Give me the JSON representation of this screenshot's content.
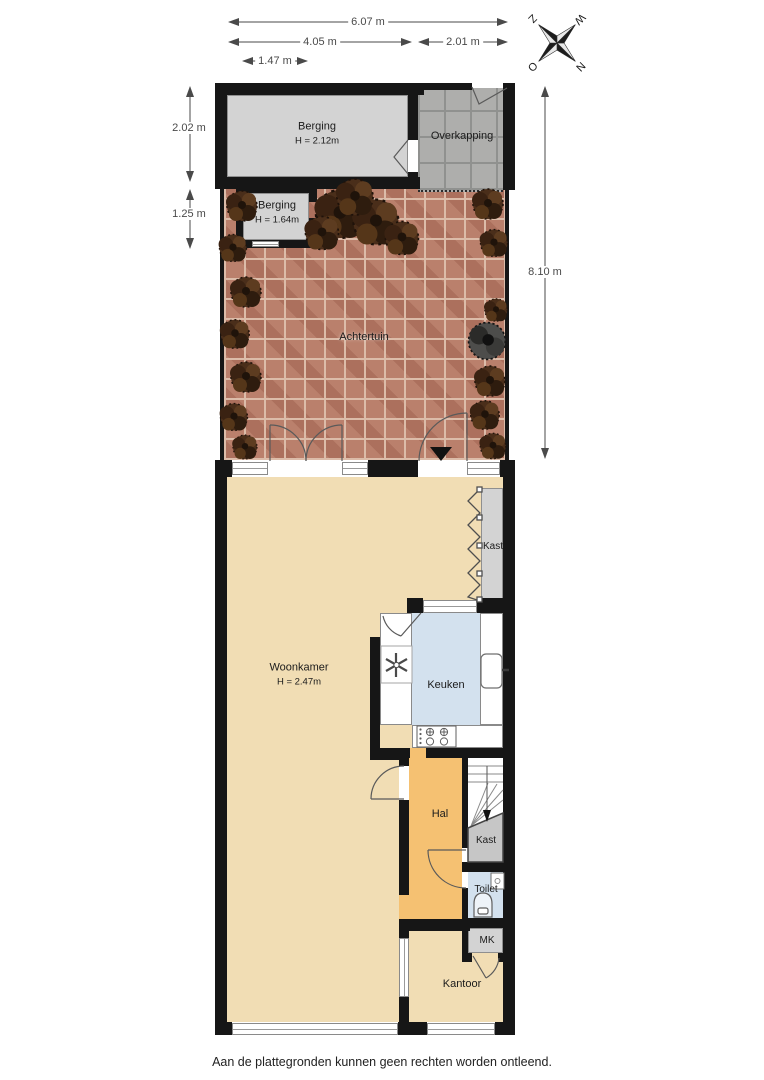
{
  "footer": {
    "disclaimer": "Aan de plattegronden kunnen geen rechten worden ontleend."
  },
  "compass": {
    "north": "N",
    "east": "O",
    "south": "Z",
    "west": "W"
  },
  "dimensions": {
    "top": [
      {
        "label": "6.07 m"
      },
      {
        "label": "4.05 m"
      },
      {
        "label": "2.01 m"
      },
      {
        "label": "1.47 m"
      }
    ],
    "left": [
      {
        "label": "2.02 m"
      },
      {
        "label": "1.25 m"
      }
    ],
    "right": [
      {
        "label": "8.10 m"
      }
    ]
  },
  "rooms": {
    "berging_groot": {
      "label": "Berging",
      "height": "H = 2.12m"
    },
    "overkapping": {
      "label": "Overkapping"
    },
    "berging_klein": {
      "label": "Berging",
      "height": "H = 1.64m"
    },
    "achtertuin": {
      "label": "Achtertuin"
    },
    "woonkamer": {
      "label": "Woonkamer",
      "height": "H = 2.47m"
    },
    "kast_woonkamer": {
      "label": "Kast"
    },
    "keuken": {
      "label": "Keuken"
    },
    "hal": {
      "label": "Hal"
    },
    "kast_trap": {
      "label": "Kast"
    },
    "toilet": {
      "label": "Toilet"
    },
    "meterkast": {
      "label": "MK"
    },
    "kantoor": {
      "label": "Kantoor"
    }
  },
  "colors": {
    "wall": "#161616",
    "floor_living": "#f1ddb4",
    "floor_hal": "#f5c172",
    "floor_wet": "#d3e1ee",
    "floor_storage": "#d3d3d3",
    "garden_brick": "#ba806c",
    "paver_gray": "#aeaeac"
  }
}
